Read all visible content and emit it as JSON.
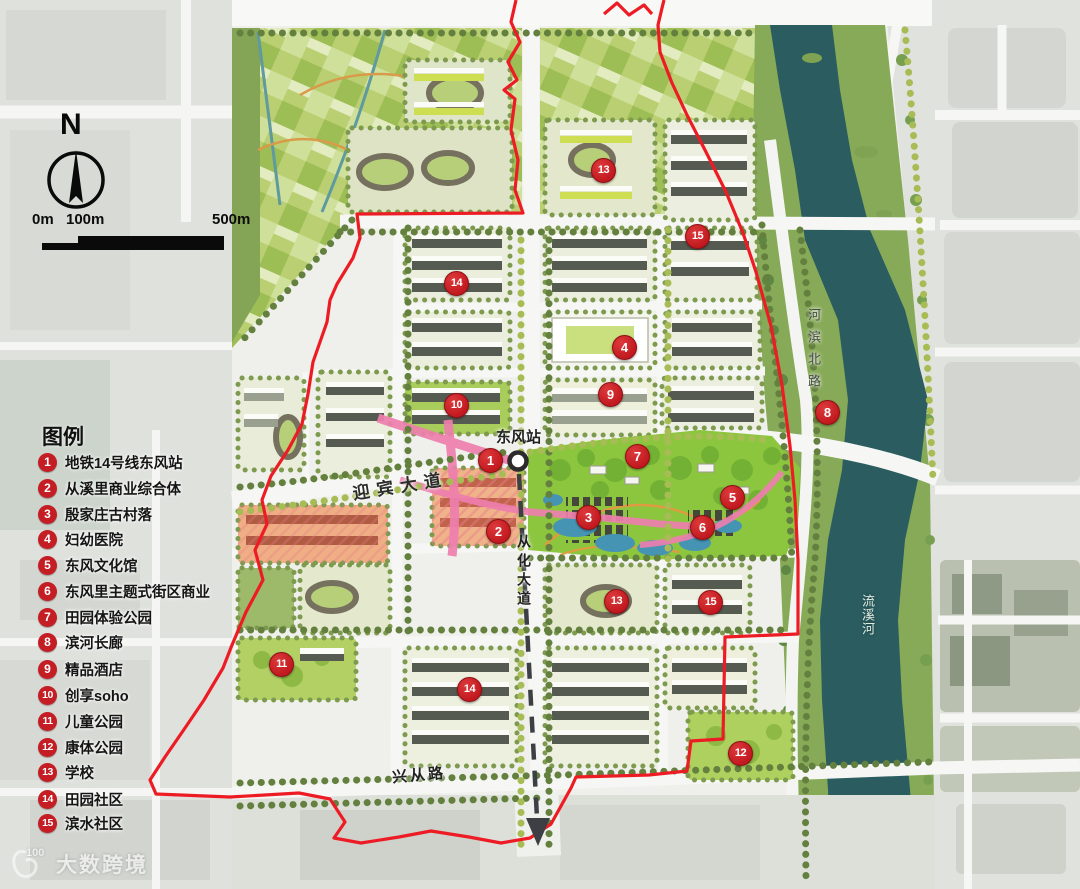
{
  "compass": {
    "label": "N"
  },
  "scale_bar": {
    "tick0": "0m",
    "tick1": "100m",
    "tick2": "500m"
  },
  "legend": {
    "title": "图例",
    "items": [
      {
        "number": "1",
        "label": "地铁14号线东风站"
      },
      {
        "number": "2",
        "label": "从溪里商业综合体"
      },
      {
        "number": "3",
        "label": "殷家庄古村落"
      },
      {
        "number": "4",
        "label": "妇幼医院"
      },
      {
        "number": "5",
        "label": "东风文化馆"
      },
      {
        "number": "6",
        "label": "东风里主题式街区商业"
      },
      {
        "number": "7",
        "label": "田园体验公园"
      },
      {
        "number": "8",
        "label": "滨河长廊"
      },
      {
        "number": "9",
        "label": "精品酒店"
      },
      {
        "number": "10",
        "label": "创享soho"
      },
      {
        "number": "11",
        "label": "儿童公园"
      },
      {
        "number": "12",
        "label": "康体公园"
      },
      {
        "number": "13",
        "label": "学校"
      },
      {
        "number": "14",
        "label": "田园社区"
      },
      {
        "number": "15",
        "label": "滨水社区"
      }
    ]
  },
  "map_labels": {
    "station": "东风站",
    "yingbin_avenue": "迎宾大道",
    "conghua_avenue": "从化大道",
    "hebin_north_road": "河滨北路",
    "liuxi_river": "流溪河",
    "xingcong_road": "兴从路"
  },
  "watermark": {
    "logo_text": "100",
    "brand": "大数跨境"
  },
  "colors": {
    "marker_red": "#c41e24",
    "boundary_red": "#ed1c24",
    "river_teal": "#2a5c60",
    "park_green": "#8cc63e"
  }
}
